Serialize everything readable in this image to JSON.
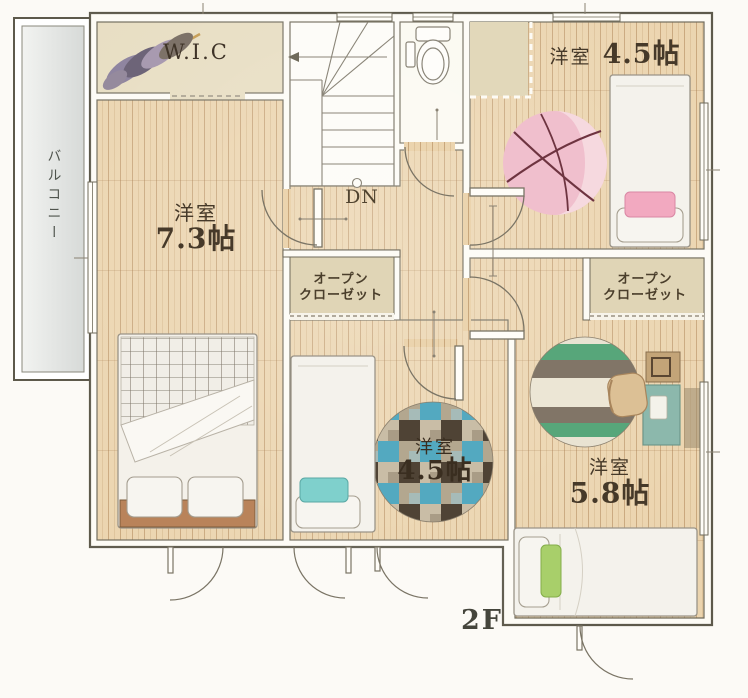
{
  "plan": {
    "floor_label": "2F",
    "balcony": {
      "label": "バルコニー"
    },
    "wic": {
      "label": "W.I.C"
    },
    "stairs": {
      "label": "DN"
    },
    "bedroom_73": {
      "type": "洋室",
      "size": "7.3帖"
    },
    "bedroom_45_top": {
      "type": "洋室",
      "size": "4.5帖"
    },
    "bedroom_45_mid": {
      "type": "洋室",
      "size": "4.5帖"
    },
    "bedroom_58": {
      "type": "洋室",
      "size": "5.8帖"
    },
    "open_closet_center": {
      "line1": "オープン",
      "line2": "クローゼット"
    },
    "open_closet_right": {
      "line1": "オープン",
      "line2": "クローゼット"
    }
  },
  "colors": {
    "wood_floor": "#ebd4ae",
    "closet_fill": "#e3d9bb",
    "wall_line": "#6f6a5a",
    "balcony_fill": "#e3e6e4",
    "rug_pink": "#f0bfcd",
    "rug_teal": "#53a9c0",
    "rug_green": "#57a67a",
    "label_brown": "#463929"
  }
}
